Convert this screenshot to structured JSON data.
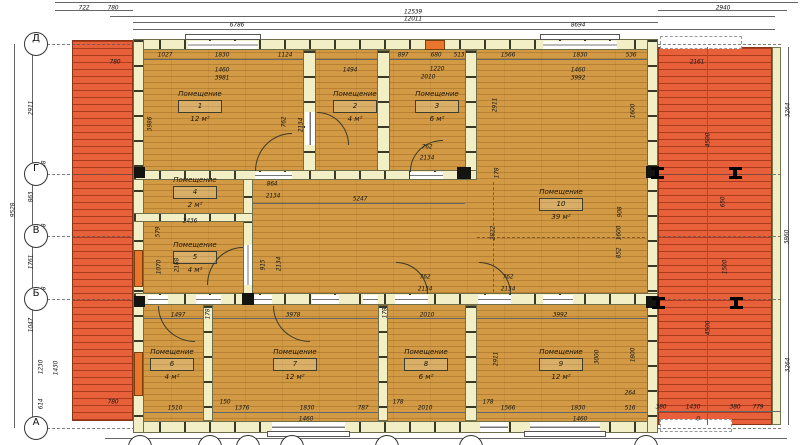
{
  "colors": {
    "floor": "#d29a44",
    "deck": "#e8603a",
    "wall": "#f2eec6",
    "door_accent": "#e8762c"
  },
  "grid": {
    "rows": [
      {
        "label": "Д",
        "y": 44
      },
      {
        "label": "Г",
        "y": 174
      },
      {
        "label": "В",
        "y": 236
      },
      {
        "label": "Б",
        "y": 299
      },
      {
        "label": "А",
        "y": 428
      }
    ],
    "bottom_bubble_x": [
      140,
      210,
      248,
      292,
      387,
      471,
      646
    ]
  },
  "rooms": [
    {
      "label": "Помещение",
      "number": "1",
      "area": "12 м²",
      "x": 200,
      "y": 90
    },
    {
      "label": "Помещение",
      "number": "2",
      "area": "4 м²",
      "x": 355,
      "y": 90
    },
    {
      "label": "Помещение",
      "number": "3",
      "area": "6 м²",
      "x": 437,
      "y": 90
    },
    {
      "label": "Помещение",
      "number": "4",
      "area": "2 м²",
      "x": 195,
      "y": 176
    },
    {
      "label": "Помещение",
      "number": "5",
      "area": "4 м²",
      "x": 195,
      "y": 241
    },
    {
      "label": "Помещение",
      "number": "6",
      "area": "4 м²",
      "x": 172,
      "y": 348
    },
    {
      "label": "Помещение",
      "number": "7",
      "area": "12 м²",
      "x": 295,
      "y": 348
    },
    {
      "label": "Помещение",
      "number": "8",
      "area": "6 м²",
      "x": 426,
      "y": 348
    },
    {
      "label": "Помещение",
      "number": "9",
      "area": "12 м²",
      "x": 561,
      "y": 348
    },
    {
      "label": "Помещение",
      "number": "10",
      "area": "39 м²",
      "x": 561,
      "y": 188
    }
  ],
  "dims": [
    {
      "t": "722",
      "x": 84,
      "y": 8
    },
    {
      "t": "780",
      "x": 113,
      "y": 8
    },
    {
      "t": "12539",
      "x": 413,
      "y": 12
    },
    {
      "t": "12011",
      "x": 413,
      "y": 19
    },
    {
      "t": "2940",
      "x": 723,
      "y": 8
    },
    {
      "t": "6786",
      "x": 237,
      "y": 25
    },
    {
      "t": "8694",
      "x": 578,
      "y": 25
    },
    {
      "t": "1027",
      "x": 165,
      "y": 55
    },
    {
      "t": "1830",
      "x": 222,
      "y": 55
    },
    {
      "t": "1124",
      "x": 285,
      "y": 55
    },
    {
      "t": "780",
      "x": 115,
      "y": 62
    },
    {
      "t": "897",
      "x": 403,
      "y": 55
    },
    {
      "t": "680",
      "x": 436,
      "y": 55
    },
    {
      "t": "513",
      "x": 459,
      "y": 55
    },
    {
      "t": "1566",
      "x": 508,
      "y": 55
    },
    {
      "t": "1830",
      "x": 580,
      "y": 55
    },
    {
      "t": "536",
      "x": 631,
      "y": 55
    },
    {
      "t": "2161",
      "x": 697,
      "y": 62
    },
    {
      "t": "1460",
      "x": 222,
      "y": 70
    },
    {
      "t": "3981",
      "x": 222,
      "y": 78
    },
    {
      "t": "1494",
      "x": 350,
      "y": 70
    },
    {
      "t": "1220",
      "x": 437,
      "y": 69
    },
    {
      "t": "2010",
      "x": 428,
      "y": 77
    },
    {
      "t": "1460",
      "x": 578,
      "y": 70
    },
    {
      "t": "3992",
      "x": 578,
      "y": 78
    },
    {
      "t": "2911",
      "x": 31,
      "y": 108,
      "r": 1
    },
    {
      "t": "138",
      "x": 44,
      "y": 166,
      "r": 1
    },
    {
      "t": "863",
      "x": 31,
      "y": 197,
      "r": 1
    },
    {
      "t": "138",
      "x": 44,
      "y": 229,
      "r": 1
    },
    {
      "t": "1761",
      "x": 31,
      "y": 262,
      "r": 1
    },
    {
      "t": "138",
      "x": 44,
      "y": 292,
      "r": 1
    },
    {
      "t": "1047",
      "x": 31,
      "y": 325,
      "r": 1
    },
    {
      "t": "1230",
      "x": 41,
      "y": 367,
      "r": 1
    },
    {
      "t": "1430",
      "x": 56,
      "y": 368,
      "r": 1
    },
    {
      "t": "614",
      "x": 41,
      "y": 404,
      "r": 1
    },
    {
      "t": "9528",
      "x": 13,
      "y": 210,
      "r": 1
    },
    {
      "t": "3986",
      "x": 150,
      "y": 124,
      "r": 1
    },
    {
      "t": "762",
      "x": 284,
      "y": 122,
      "r": 1
    },
    {
      "t": "2134",
      "x": 301,
      "y": 125,
      "r": 1
    },
    {
      "t": "762",
      "x": 427,
      "y": 147
    },
    {
      "t": "2134",
      "x": 427,
      "y": 158
    },
    {
      "t": "864",
      "x": 272,
      "y": 184
    },
    {
      "t": "2134",
      "x": 273,
      "y": 196
    },
    {
      "t": "5247",
      "x": 360,
      "y": 199
    },
    {
      "t": "2436",
      "x": 190,
      "y": 221
    },
    {
      "t": "178",
      "x": 497,
      "y": 173,
      "r": 1
    },
    {
      "t": "2822",
      "x": 493,
      "y": 233,
      "r": 1
    },
    {
      "t": "579",
      "x": 158,
      "y": 232,
      "r": 1
    },
    {
      "t": "1070",
      "x": 159,
      "y": 267,
      "r": 1
    },
    {
      "t": "2188",
      "x": 177,
      "y": 265,
      "r": 1
    },
    {
      "t": "915",
      "x": 263,
      "y": 265,
      "r": 1
    },
    {
      "t": "2134",
      "x": 279,
      "y": 264,
      "r": 1
    },
    {
      "t": "2911",
      "x": 495,
      "y": 105,
      "r": 1
    },
    {
      "t": "1600",
      "x": 633,
      "y": 111,
      "r": 1
    },
    {
      "t": "908",
      "x": 620,
      "y": 212,
      "r": 1
    },
    {
      "t": "1600",
      "x": 619,
      "y": 233,
      "r": 1
    },
    {
      "t": "852",
      "x": 619,
      "y": 253,
      "r": 1
    },
    {
      "t": "762",
      "x": 425,
      "y": 277
    },
    {
      "t": "2134",
      "x": 425,
      "y": 289
    },
    {
      "t": "762",
      "x": 508,
      "y": 277
    },
    {
      "t": "2134",
      "x": 508,
      "y": 289
    },
    {
      "t": "1497",
      "x": 178,
      "y": 315
    },
    {
      "t": "178",
      "x": 208,
      "y": 314,
      "r": 1
    },
    {
      "t": "3978",
      "x": 293,
      "y": 315
    },
    {
      "t": "178",
      "x": 385,
      "y": 313,
      "r": 1
    },
    {
      "t": "2010",
      "x": 427,
      "y": 315
    },
    {
      "t": "3992",
      "x": 560,
      "y": 315
    },
    {
      "t": "2911",
      "x": 496,
      "y": 359,
      "r": 1
    },
    {
      "t": "3000",
      "x": 597,
      "y": 357,
      "r": 1
    },
    {
      "t": "1800",
      "x": 633,
      "y": 355,
      "r": 1
    },
    {
      "t": "780",
      "x": 113,
      "y": 402
    },
    {
      "t": "1510",
      "x": 175,
      "y": 408
    },
    {
      "t": "150",
      "x": 225,
      "y": 402
    },
    {
      "t": "1376",
      "x": 242,
      "y": 408
    },
    {
      "t": "1830",
      "x": 307,
      "y": 408
    },
    {
      "t": "1460",
      "x": 306,
      "y": 419
    },
    {
      "t": "787",
      "x": 363,
      "y": 408
    },
    {
      "t": "178",
      "x": 398,
      "y": 402
    },
    {
      "t": "2010",
      "x": 425,
      "y": 408
    },
    {
      "t": "178",
      "x": 488,
      "y": 402
    },
    {
      "t": "1566",
      "x": 508,
      "y": 408
    },
    {
      "t": "1830",
      "x": 578,
      "y": 408
    },
    {
      "t": "516",
      "x": 630,
      "y": 408
    },
    {
      "t": "264",
      "x": 630,
      "y": 393
    },
    {
      "t": "1460",
      "x": 580,
      "y": 419
    },
    {
      "t": "380",
      "x": 661,
      "y": 407
    },
    {
      "t": "1430",
      "x": 693,
      "y": 407
    },
    {
      "t": "380",
      "x": 735,
      "y": 407
    },
    {
      "t": "779",
      "x": 758,
      "y": 407
    },
    {
      "t": "0",
      "x": 698,
      "y": 419
    },
    {
      "t": "3264",
      "x": 788,
      "y": 110,
      "r": 1
    },
    {
      "t": "3860",
      "x": 787,
      "y": 237,
      "r": 1
    },
    {
      "t": "3264",
      "x": 788,
      "y": 365,
      "r": 1
    },
    {
      "t": "4500",
      "x": 708,
      "y": 140,
      "r": 1
    },
    {
      "t": "650",
      "x": 723,
      "y": 202,
      "r": 1
    },
    {
      "t": "1500",
      "x": 725,
      "y": 267,
      "r": 1
    },
    {
      "t": "4500",
      "x": 708,
      "y": 328,
      "r": 1
    }
  ]
}
